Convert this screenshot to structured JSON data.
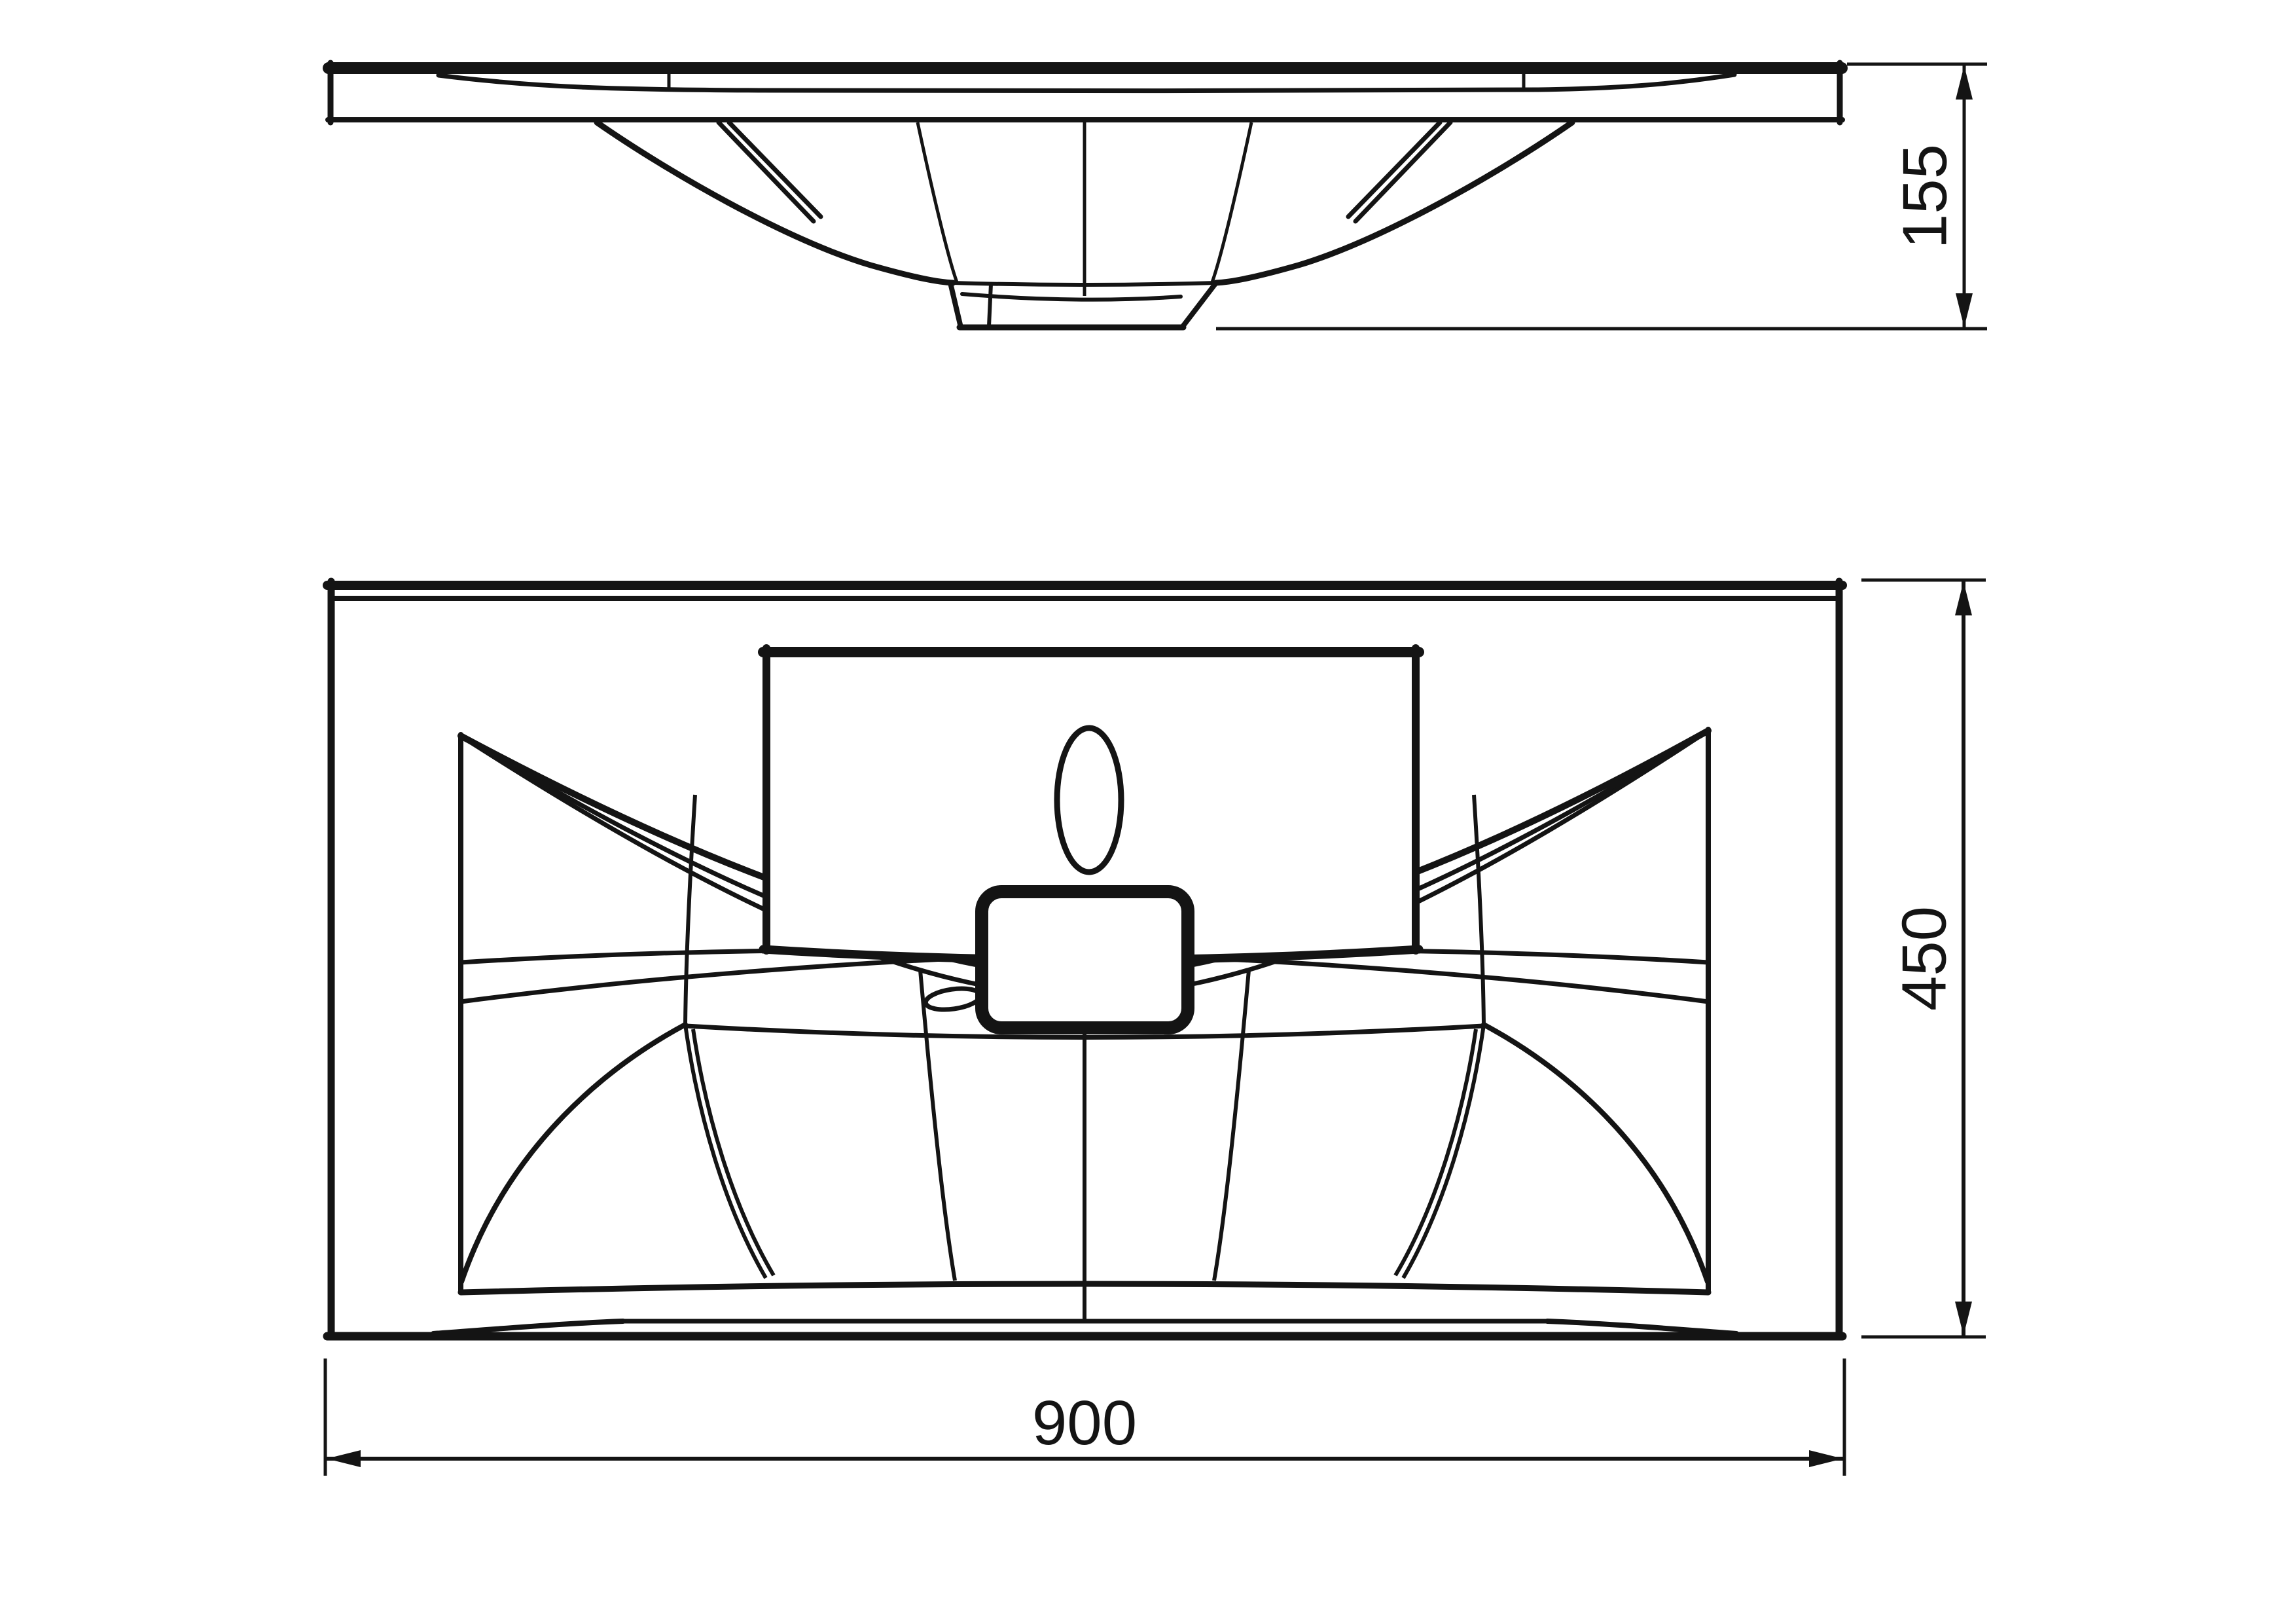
{
  "drawing": {
    "title": "Washbasin technical drawing, two orthographic views",
    "background_color": "#ffffff",
    "line_color": "#141414",
    "views": {
      "front_view": {
        "name": "front elevation (section through bowl and drain)"
      },
      "plan_view": {
        "name": "top plan view with faucet deck, overflow and drain"
      }
    },
    "dimensions": {
      "height": {
        "value": "155",
        "orientation": "vertical",
        "applies_to": "front view overall height"
      },
      "depth": {
        "value": "450",
        "orientation": "vertical",
        "applies_to": "plan view overall depth"
      },
      "width": {
        "value": "900",
        "orientation": "horizontal",
        "applies_to": "plan view overall width"
      }
    }
  }
}
